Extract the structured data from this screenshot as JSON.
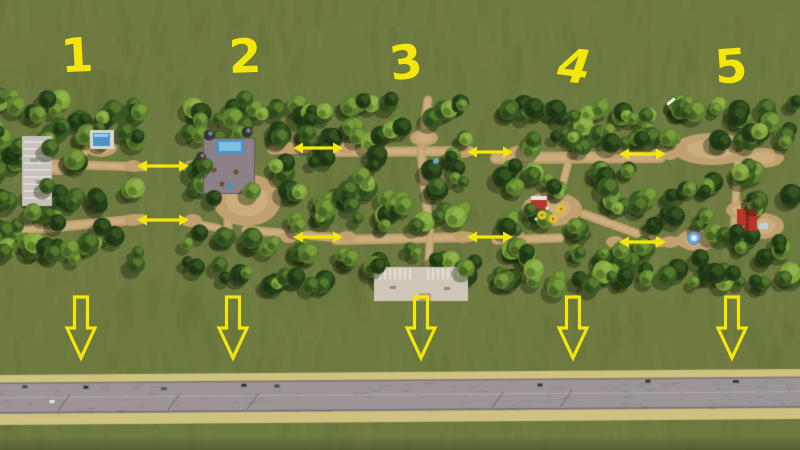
{
  "labels": {
    "zones": [
      "1",
      "2",
      "3",
      "4",
      "5"
    ]
  },
  "annotations": {
    "color": "#f2e60a",
    "zone_connections": [
      {
        "from": "1",
        "to": "2",
        "arrow_count": 2
      },
      {
        "from": "2",
        "to": "3",
        "arrow_count": 2
      },
      {
        "from": "3",
        "to": "4",
        "arrow_count": 2
      },
      {
        "from": "4",
        "to": "5",
        "arrow_count": 2
      }
    ],
    "road_access_arrow_count": 5,
    "icons": {
      "connection_arrow": "double-headed horizontal arrow ↔",
      "road_access_arrow": "hollow outlined down arrow ⇩"
    }
  },
  "palette": {
    "grass": "#6d7a40",
    "grass_light": "#8b9258",
    "grass_dark": "#55632f",
    "dirt": "#c2a170",
    "dirt_light": "#d6bb8c",
    "dirt_dark": "#9b7c50",
    "tree_dark": "#243f18",
    "tree_mid": "#3a5a23",
    "tree_light": "#5d8030",
    "tree_bright": "#7fa33d",
    "road_asphalt": "#9c9496",
    "road_shoulder": "#cfc17f",
    "road_edge": "#5f5b5c",
    "parking_lot": "#c9c2bc",
    "pool_blue": "#4a93c4",
    "building_red": "#b63629",
    "umbrella_yellow": "#e5c02c",
    "shadow": "rgba(24,33,11,0.38)"
  }
}
